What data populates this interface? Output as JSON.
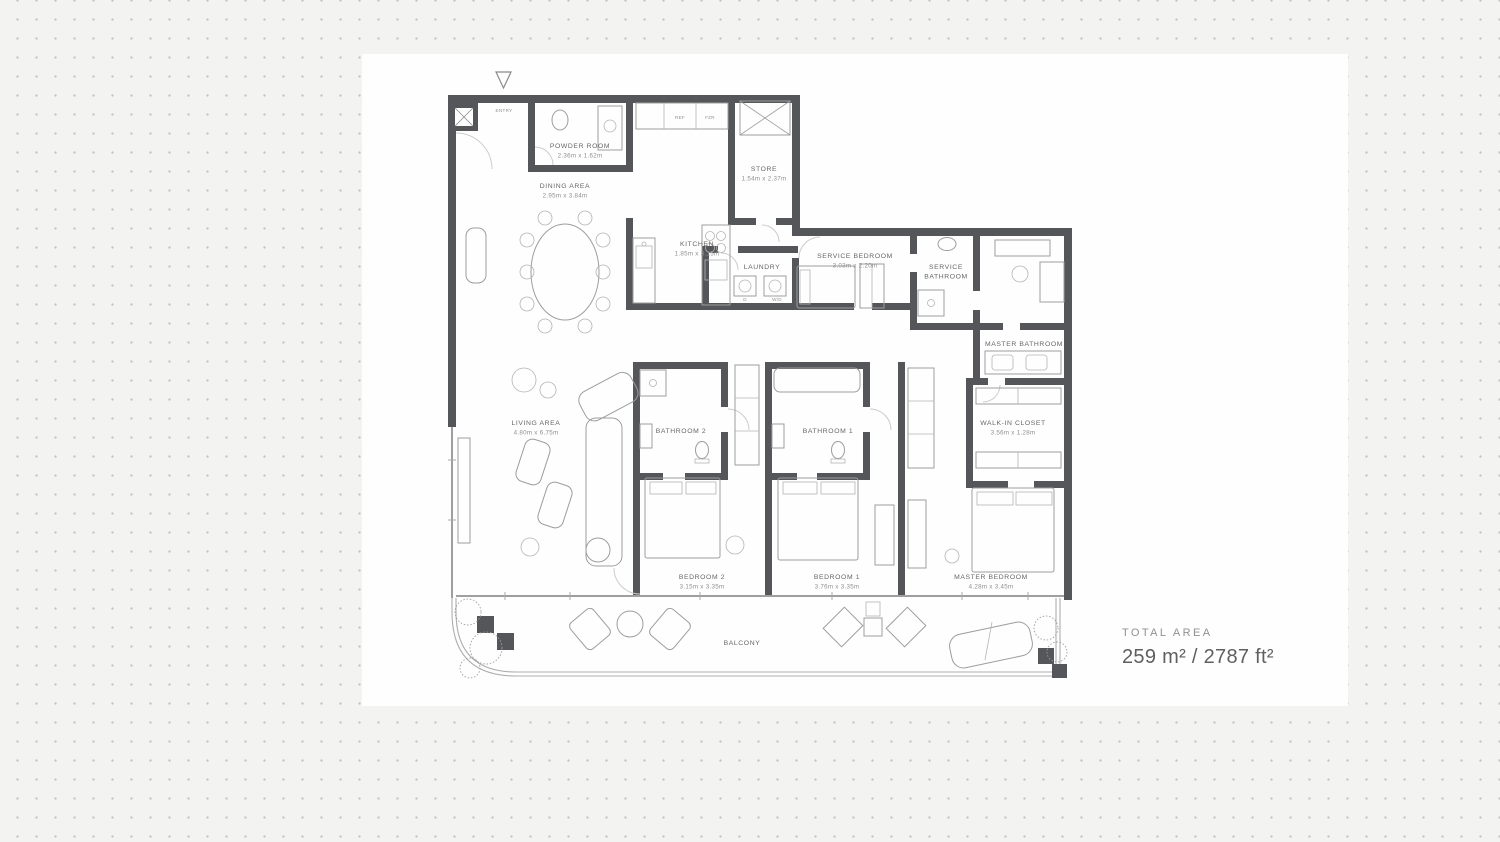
{
  "colors": {
    "background": "#f3f3f2",
    "dots": "#c5c5c5",
    "panel": "#fefefe",
    "wall": "#55565a",
    "label_text": "#666666",
    "dims_text": "#8f8f8f"
  },
  "plan": {
    "entry_label": "ENTRY",
    "labels": {
      "powder_name": "POWDER ROOM",
      "powder_dims": "2.36m x 1.62m",
      "dining_name": "DINING AREA",
      "dining_dims": "2.95m x 3.84m",
      "store_name": "STORE",
      "store_dims": "1.54m x 2.37m",
      "kitchen_name": "KITCHEN",
      "kitchen_dims": "1.85m x 3.15m",
      "laundry_name": "LAUNDRY",
      "service_bedroom_name": "SERVICE BEDROOM",
      "service_bedroom_dims": "3.03m x 2.20m",
      "service_bathroom_line1": "SERVICE",
      "service_bathroom_line2": "BATHROOM",
      "master_bathroom_name": "MASTER BATHROOM",
      "wic_name": "WALK-IN CLOSET",
      "wic_dims": "3.56m x 1.28m",
      "living_name": "LIVING AREA",
      "living_dims": "4.80m x 6.75m",
      "bathroom2_name": "BATHROOM 2",
      "bathroom1_name": "BATHROOM 1",
      "bedroom2_name": "BEDROOM 2",
      "bedroom2_dims": "3.15m x 3.35m",
      "bedroom1_name": "BEDROOM 1",
      "bedroom1_dims": "3.76m x 3.35m",
      "master_bedroom_name": "MASTER BEDROOM",
      "master_bedroom_dims": "4.28m x 3.45m",
      "balcony_name": "BALCONY",
      "dryer": "D",
      "washer_dryer": "W/D",
      "ref": "REF",
      "fzr": "FZR"
    }
  },
  "total_area": {
    "label": "TOTAL AREA",
    "value": "259 m² / 2787 ft²"
  }
}
